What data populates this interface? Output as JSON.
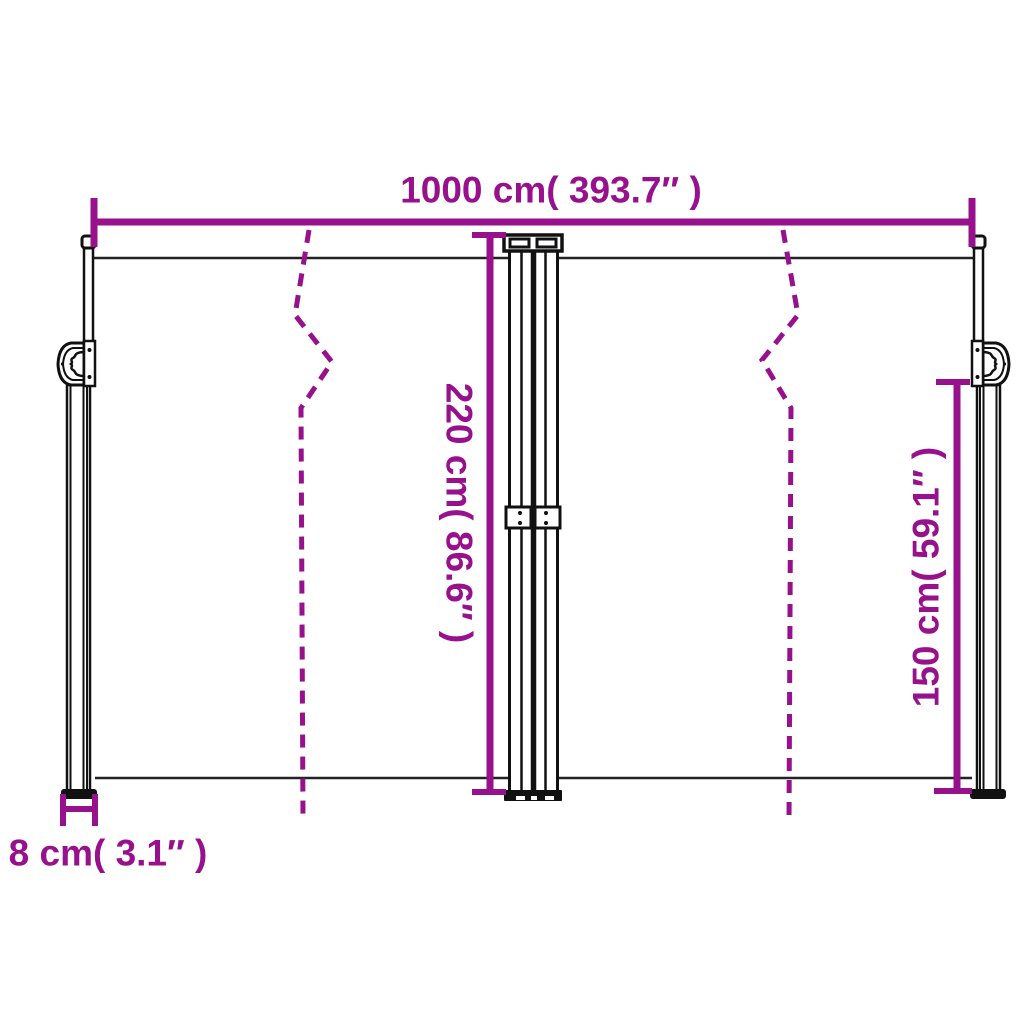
{
  "diagram": {
    "type": "product-dimension-diagram",
    "subject": "retractable-double-side-awning",
    "background_color": "#ffffff",
    "accent_color": "#97118C",
    "line_color": "#111111",
    "labels": {
      "total_width": "1000 cm( 393.7″ )",
      "total_height": "220 cm( 86.6″ )",
      "side_height": "150 cm( 59.1″ )",
      "post_depth": "8 cm( 3.1″ )"
    },
    "values": {
      "total_width_cm": "1000",
      "total_width_in": "393.7",
      "total_height_cm": "220",
      "total_height_in": "86.6",
      "side_height_cm": "150",
      "side_height_in": "59.1",
      "post_depth_cm": "8",
      "post_depth_in": "3.1"
    }
  }
}
